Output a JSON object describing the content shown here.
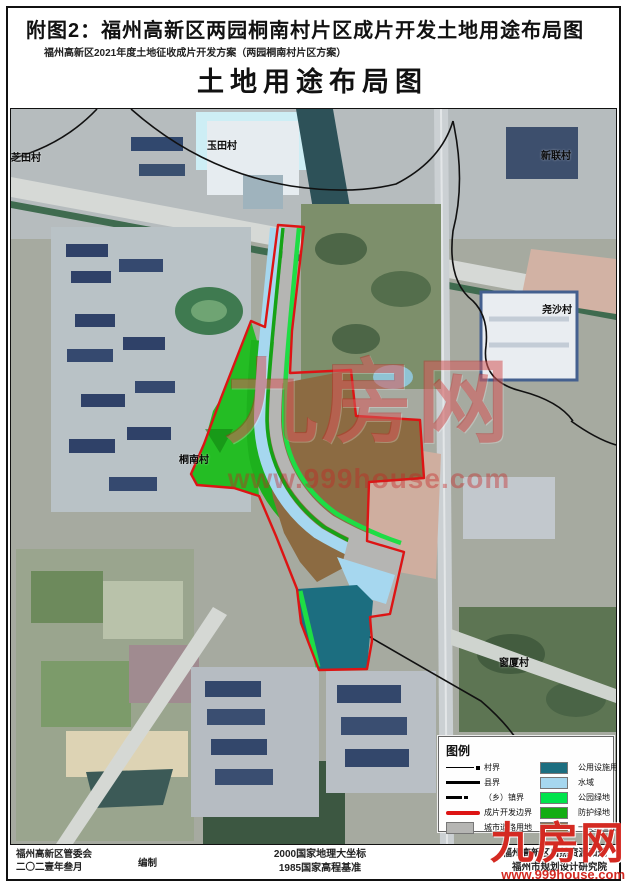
{
  "header": {
    "figure_title": "附图2：福州高新区两园桐南村片区成片开发土地用途布局图",
    "subtitle": "福州高新区2021年度土地征收成片开发方案（两园桐南村片区方案）",
    "map_title": "土地用途布局图"
  },
  "map": {
    "labels": [
      {
        "text": "芝田村"
      },
      {
        "text": "玉田村"
      },
      {
        "text": "新联村"
      },
      {
        "text": "尧沙村"
      },
      {
        "text": "桐南村"
      },
      {
        "text": "窗厦村"
      }
    ]
  },
  "legend": {
    "title": "图例",
    "left": [
      {
        "label": "村界",
        "symbol": "line-dot"
      },
      {
        "label": "县界",
        "symbol": "thick-line"
      },
      {
        "label": "（乡）镇界",
        "symbol": "dashed-line"
      },
      {
        "label": "成片开发边界",
        "symbol": "red-line"
      },
      {
        "label": "城市道路用地",
        "symbol": "swatch",
        "color": "#b5b5b3"
      }
    ],
    "right": [
      {
        "label": "公用设施用地",
        "color": "#1c6e80"
      },
      {
        "label": "水域",
        "color": "#a6d7ef"
      },
      {
        "label": "公园绿地",
        "color": "#00e44c"
      },
      {
        "label": "防护绿地",
        "color": "#13ad13"
      },
      {
        "label": "一类工业用地",
        "color": "#8c6b42"
      }
    ]
  },
  "footer": {
    "left_org": "福州高新区管委会",
    "left_date": "二〇二壹年叁月",
    "left_role": "编制",
    "center_line1": "2000国家地理大坐标",
    "center_line2": "1985国家高程基准",
    "right_line1": "福州高新区自然资源和规",
    "right_line2": "福州市规划设计研究院"
  },
  "watermark": {
    "name": "九房网",
    "url": "www.999house.com"
  },
  "colors": {
    "boundary_red": "#dd1414",
    "road_gray": "#b5b5b3",
    "water_blue": "#a6d7ef",
    "park_green": "#00e44c",
    "protect_green": "#13ad13",
    "utility_teal": "#1c6e80",
    "industrial_brown": "#8c6b42"
  }
}
